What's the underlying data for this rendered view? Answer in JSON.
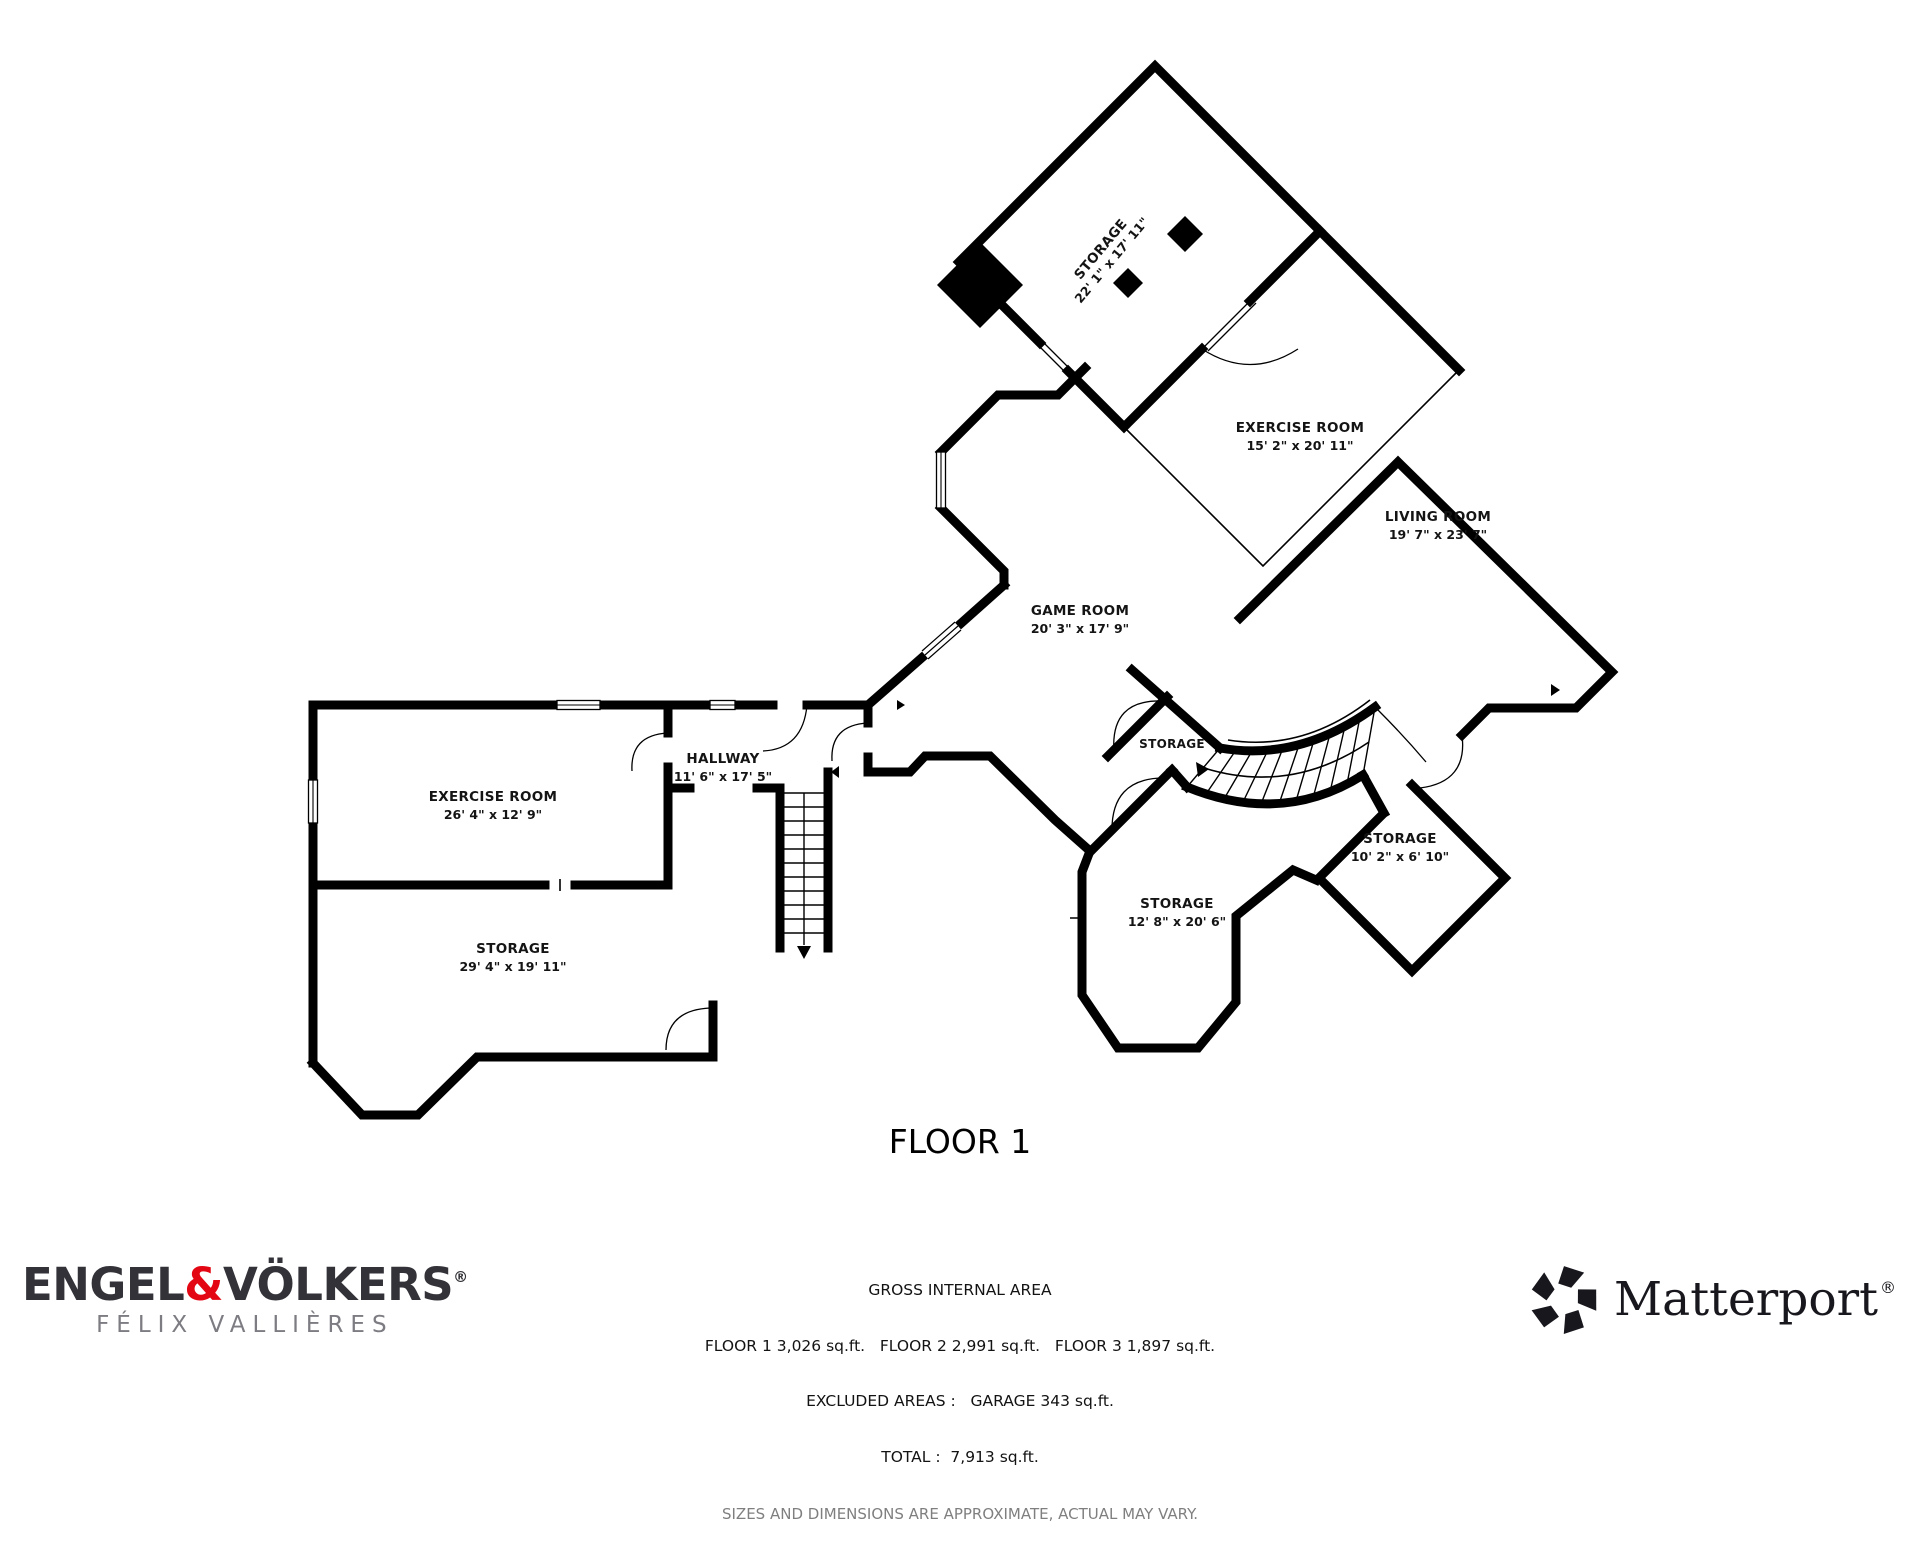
{
  "floor_title": "FLOOR 1",
  "rooms": [
    {
      "name": "STORAGE",
      "dims": "22' 1\" x 17' 11\""
    },
    {
      "name": "EXERCISE ROOM",
      "dims": "15' 2\" x 20' 11\""
    },
    {
      "name": "LIVING ROOM",
      "dims": "19' 7\" x 23' 7\""
    },
    {
      "name": "GAME ROOM",
      "dims": "20' 3\" x 17' 9\""
    },
    {
      "name": "HALLWAY",
      "dims": "11' 6\" x 17' 5\""
    },
    {
      "name": "EXERCISE ROOM",
      "dims": "26' 4\" x 12' 9\""
    },
    {
      "name": "STORAGE",
      "dims": "29' 4\" x 19' 11\""
    },
    {
      "name": "STORAGE",
      "dims": ""
    },
    {
      "name": "STORAGE",
      "dims": "10' 2\" x 6' 10\""
    },
    {
      "name": "STORAGE",
      "dims": "12' 8\" x 20' 6\""
    }
  ],
  "footer": {
    "gross_title": "GROSS INTERNAL AREA",
    "floors_line": "FLOOR 1 3,026 sq.ft.   FLOOR 2 2,991 sq.ft.   FLOOR 3 1,897 sq.ft.",
    "excluded_line": "EXCLUDED AREAS :   GARAGE 343 sq.ft.",
    "total_line": "TOTAL :  7,913 sq.ft.",
    "disclaimer": "SIZES AND DIMENSIONS ARE APPROXIMATE, ACTUAL MAY VARY."
  },
  "branding": {
    "engel_voelkers": {
      "name_left": "ENGEL",
      "ampersand": "&",
      "name_right": "VÖLKERS",
      "registered": "®",
      "agent": "FÉLIX VALLIÈRES"
    },
    "matterport": {
      "name": "Matterport",
      "registered": "®",
      "icon": "pinwheel-icon"
    }
  },
  "colors": {
    "wall": "#000000",
    "ev_red": "#e30613",
    "ev_dark": "#323238",
    "agent_gray": "#7c7c82",
    "matterport_dark": "#17171d",
    "disclaimer_gray": "#7f7f7f"
  }
}
